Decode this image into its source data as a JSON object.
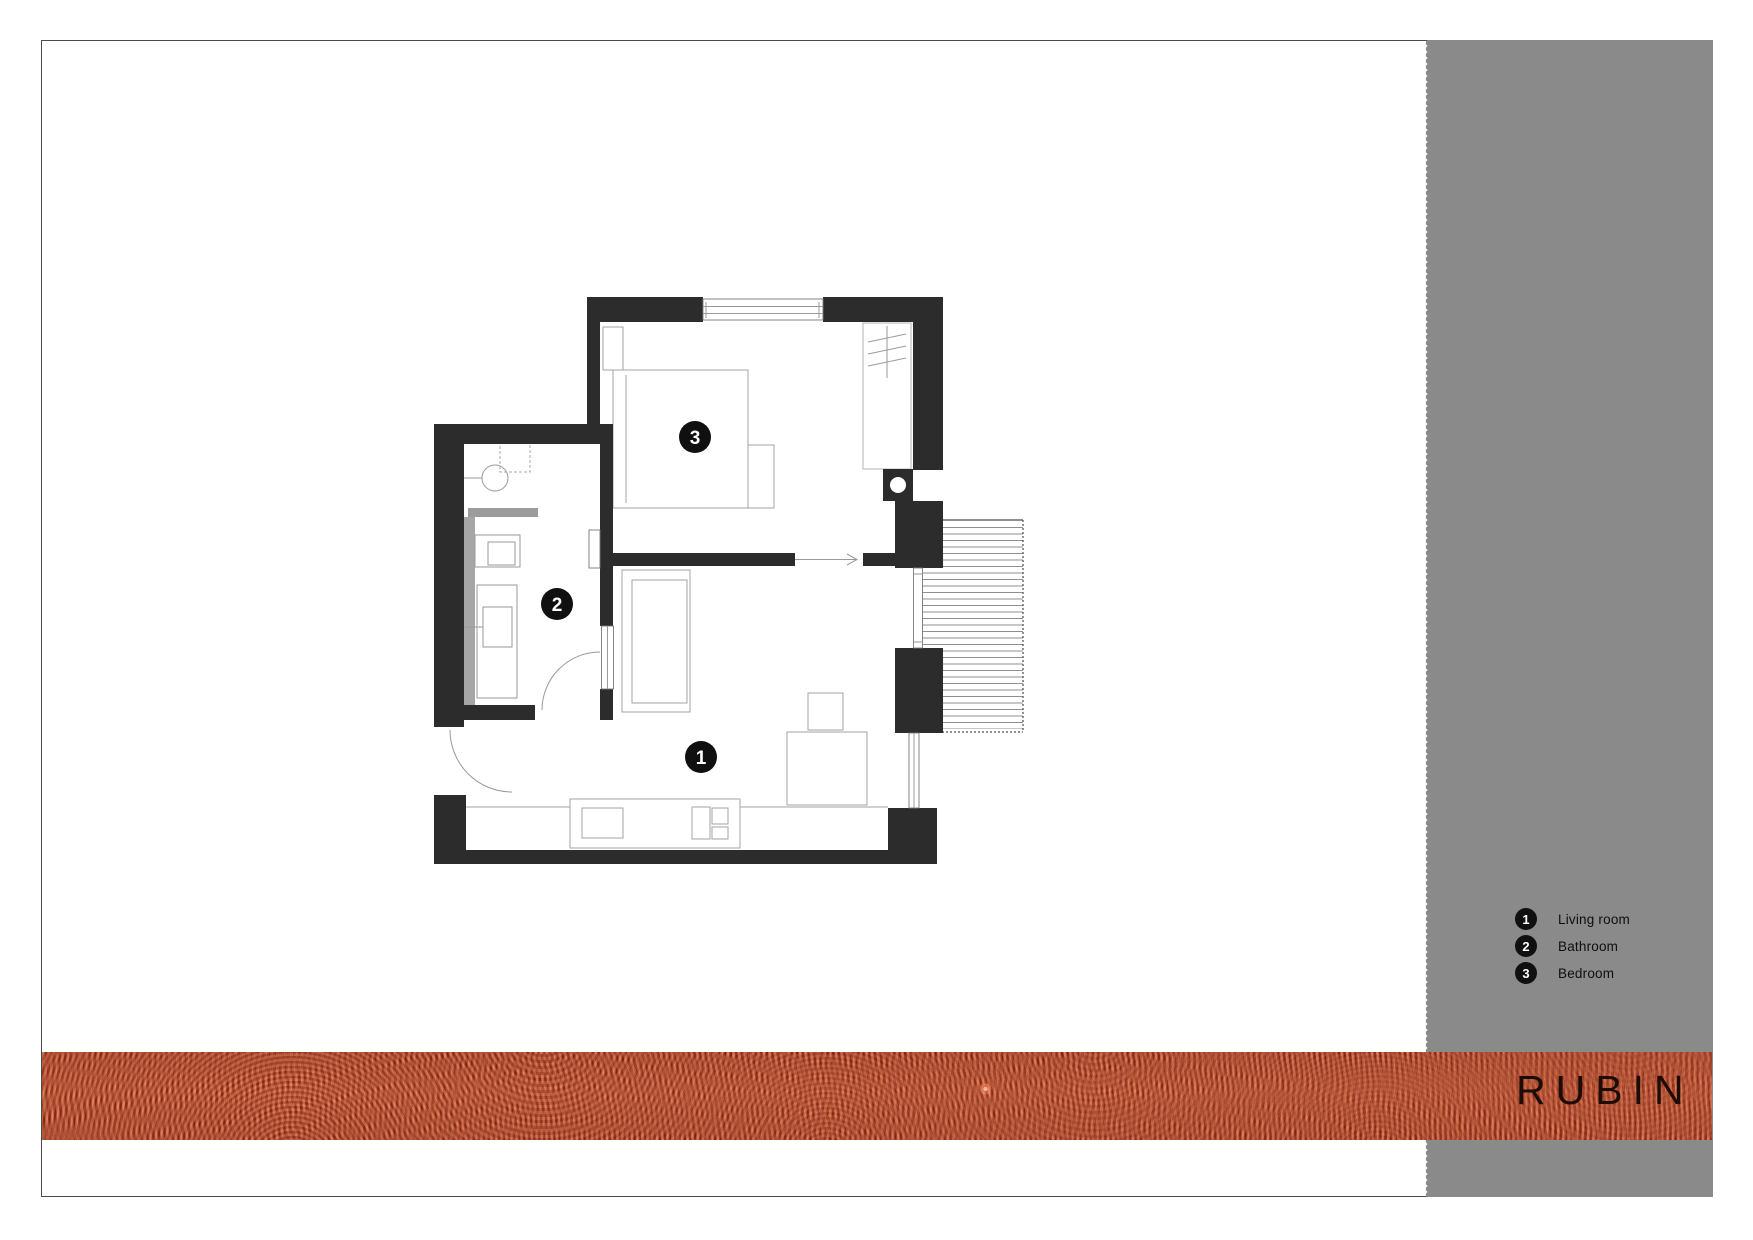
{
  "rooms": [
    {
      "num": "1",
      "label": "Living room"
    },
    {
      "num": "2",
      "label": "Bathroom"
    },
    {
      "num": "3",
      "label": "Bedroom"
    }
  ],
  "brand": {
    "name": "RUBIN"
  },
  "colors": {
    "sidebar_gray": "#8a8a8a",
    "wall_black": "#2c2c2c",
    "band_red": "#af4330",
    "brand_text": "#1c0c05",
    "page_border": "#4b4b4b",
    "marker_black": "#101010"
  }
}
